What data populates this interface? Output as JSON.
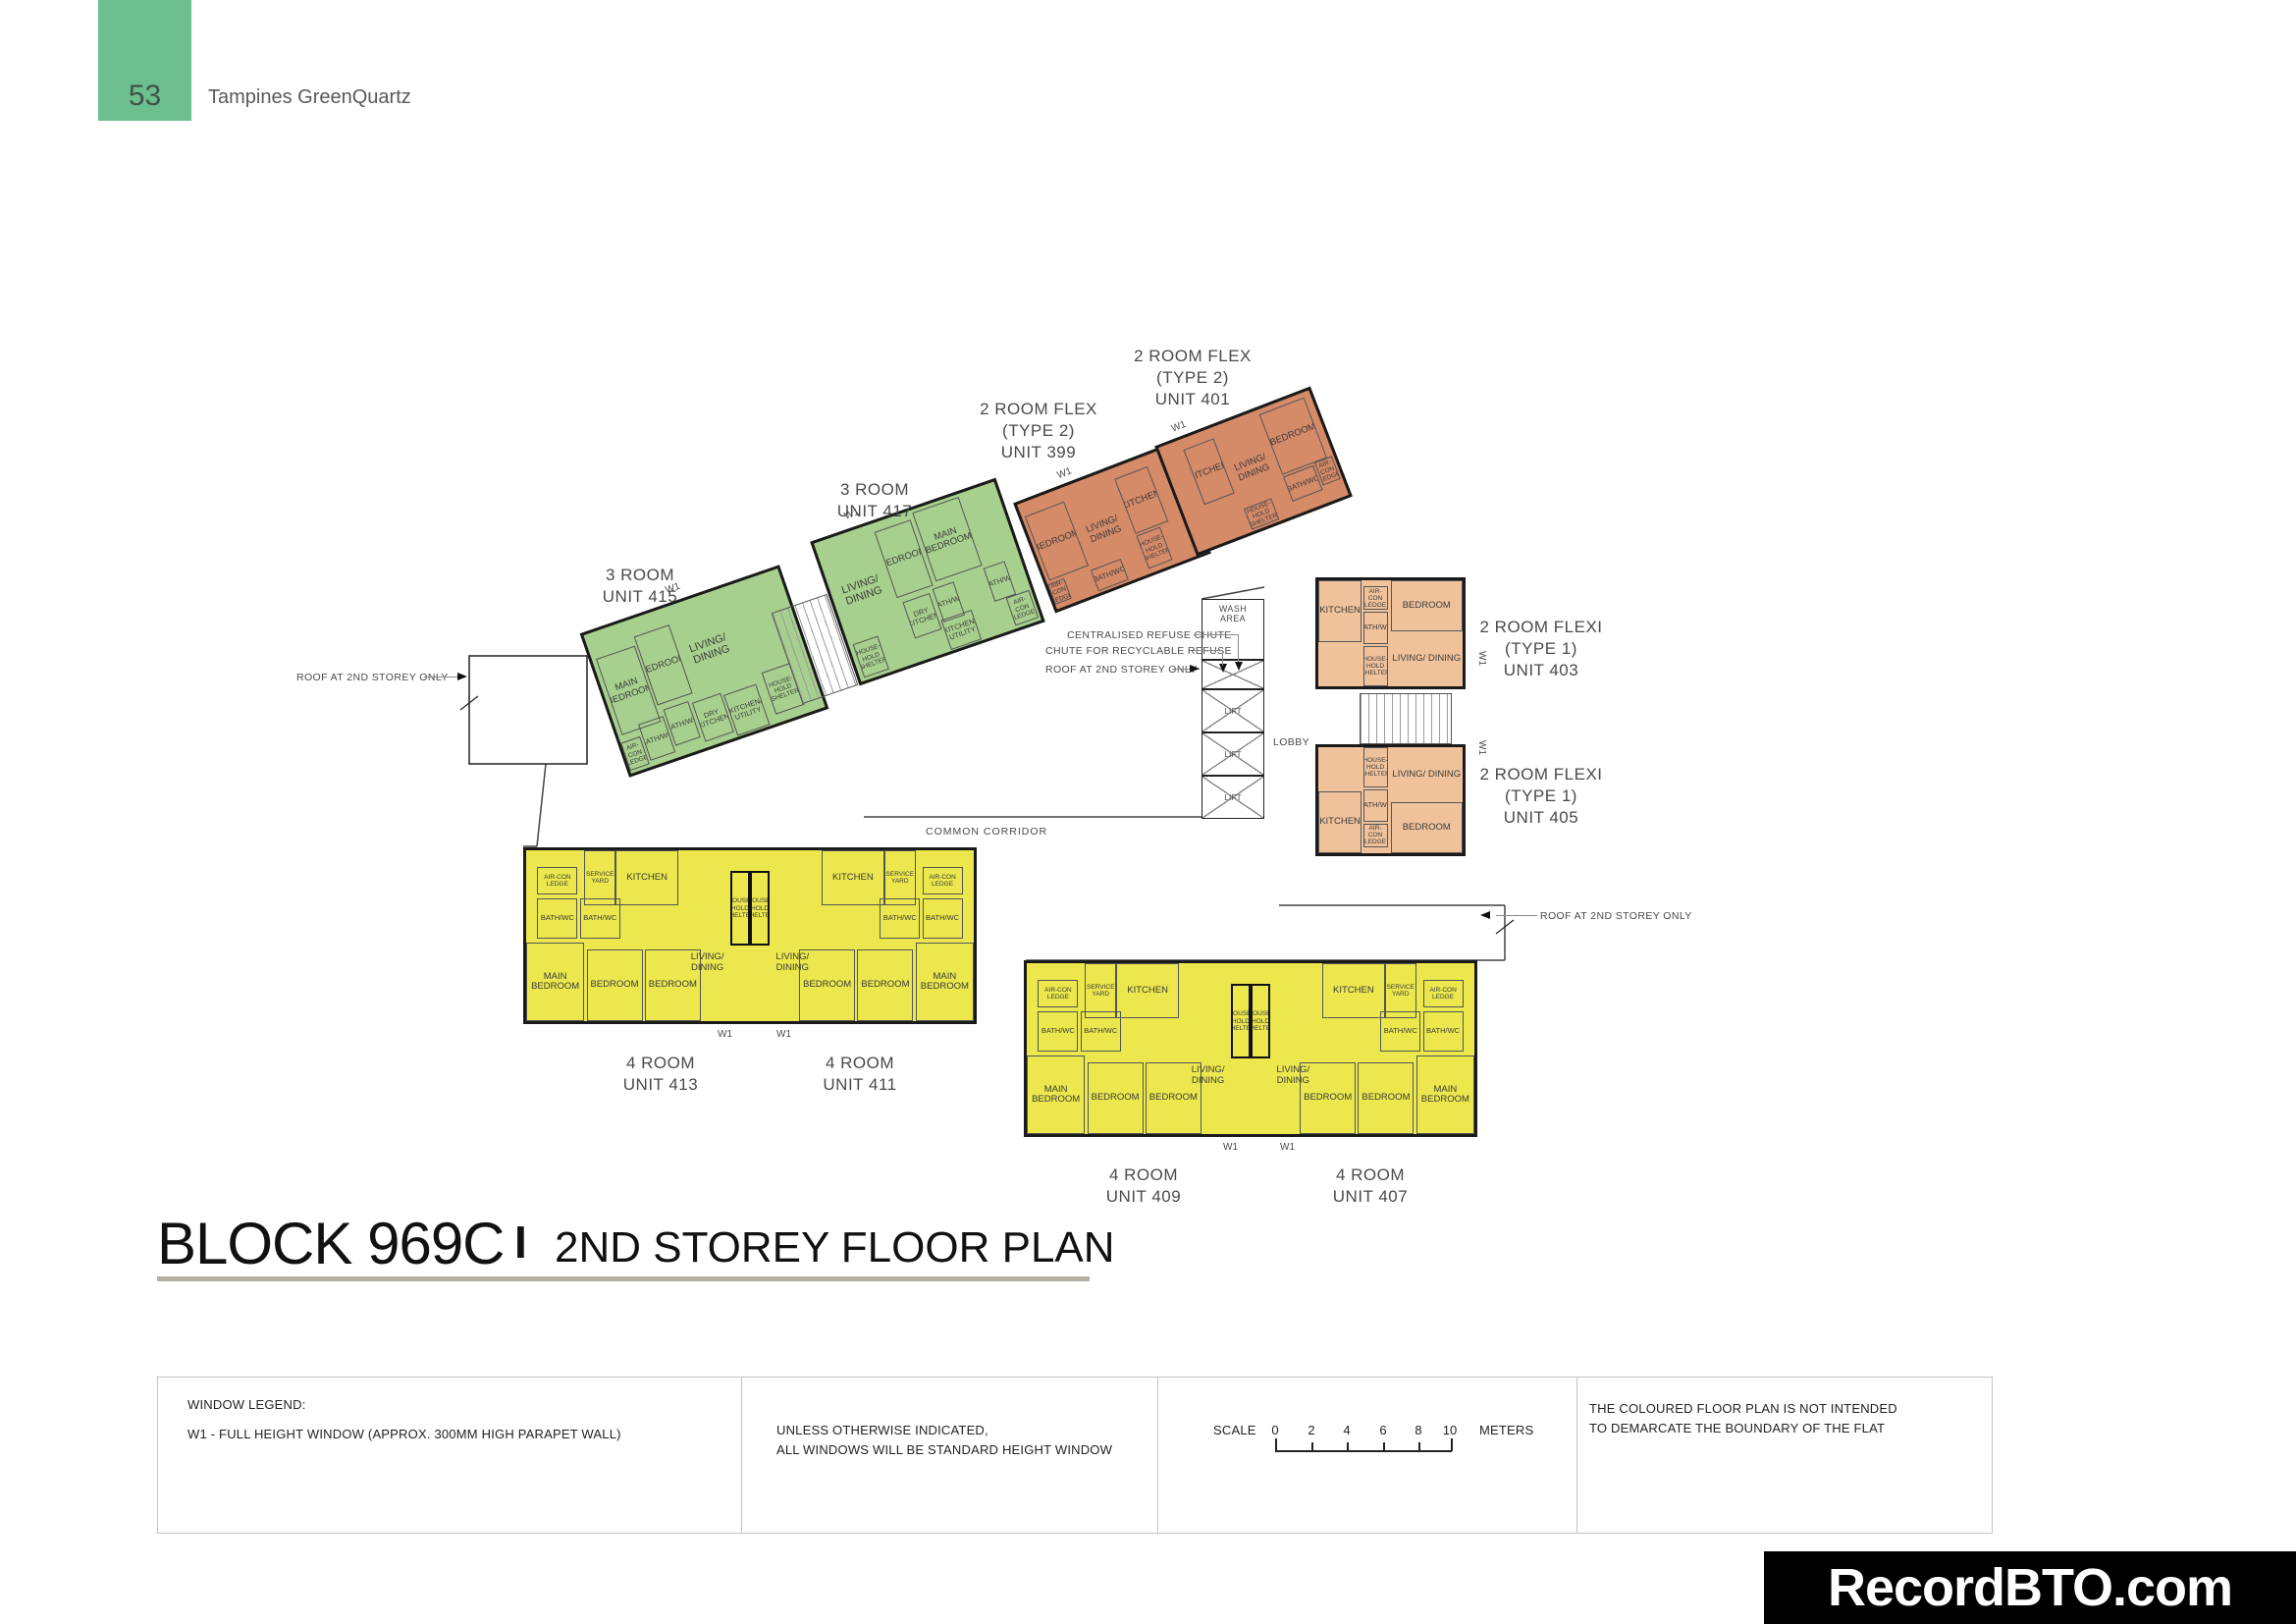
{
  "page": {
    "number": "53",
    "project": "Tampines GreenQuartz"
  },
  "title": {
    "block": "BLOCK 969C",
    "separator": "I",
    "subtitle": "2ND STOREY FLOOR PLAN"
  },
  "watermark": "RecordBTO.com",
  "colors": {
    "header_green": "#6cbf8e",
    "unit_green": "#a7d08e",
    "unit_orange": "#d58a68",
    "unit_peach": "#f0c29c",
    "unit_yellow": "#ebe74d",
    "wall": "#1a1a1a",
    "underline": "#b2b1a1"
  },
  "rooms": {
    "main_bedroom": "MAIN BEDROOM",
    "bedroom": "BEDROOM",
    "living_dining": "LIVING/ DINING",
    "kitchen": "KITCHEN",
    "dry_kitchen": "DRY KITCHEN",
    "kitchen_utility": "KITCHEN/ UTILITY",
    "bath_wc": "BATH/WC",
    "aircon_ledge": "AIR-CON LEDGE",
    "household_shelter": "HOUSE- HOLD SHELTER",
    "service_yard": "SERVICE YARD",
    "wash_area": "WASH AREA",
    "lobby": "LOBBY",
    "lift": "LIFT",
    "common_corridor": "COMMON CORRIDOR",
    "w1": "W1"
  },
  "units": {
    "u415": {
      "l1": "3 ROOM",
      "l2": "UNIT 415"
    },
    "u417": {
      "l1": "3 ROOM",
      "l2": "UNIT 417"
    },
    "u399": {
      "l1": "2 ROOM FLEX",
      "l2": "(TYPE 2)",
      "l3": "UNIT 399"
    },
    "u401": {
      "l1": "2 ROOM FLEX",
      "l2": "(TYPE 2)",
      "l3": "UNIT 401"
    },
    "u403": {
      "l1": "2 ROOM FLEXI",
      "l2": "(TYPE 1)",
      "l3": "UNIT 403"
    },
    "u405": {
      "l1": "2 ROOM FLEXI",
      "l2": "(TYPE 1)",
      "l3": "UNIT 405"
    },
    "u413": {
      "l1": "4 ROOM",
      "l2": "UNIT 413"
    },
    "u411": {
      "l1": "4 ROOM",
      "l2": "UNIT 411"
    },
    "u409": {
      "l1": "4 ROOM",
      "l2": "UNIT 409"
    },
    "u407": {
      "l1": "4 ROOM",
      "l2": "UNIT 407"
    }
  },
  "annotations": {
    "centralised_refuse": "CENTRALISED REFUSE CHUTE",
    "recyclable_refuse": "CHUTE FOR RECYCLABLE REFUSE",
    "roof_2nd_storey": "ROOF AT 2ND STOREY ONLY"
  },
  "legend": {
    "window_legend_title": "WINDOW LEGEND:",
    "w1_line": "W1 -  FULL HEIGHT WINDOW (APPROX. 300MM HIGH PARAPET WALL)",
    "unless_line1": "UNLESS OTHERWISE INDICATED,",
    "unless_line2": "ALL WINDOWS WILL BE STANDARD HEIGHT WINDOW",
    "scale_label": "SCALE",
    "scale_ticks": [
      "0",
      "2",
      "4",
      "6",
      "8",
      "10"
    ],
    "scale_unit": "METERS",
    "note_line1": "THE COLOURED FLOOR PLAN IS NOT INTENDED",
    "note_line2": "TO DEMARCATE THE BOUNDARY OF THE FLAT"
  }
}
